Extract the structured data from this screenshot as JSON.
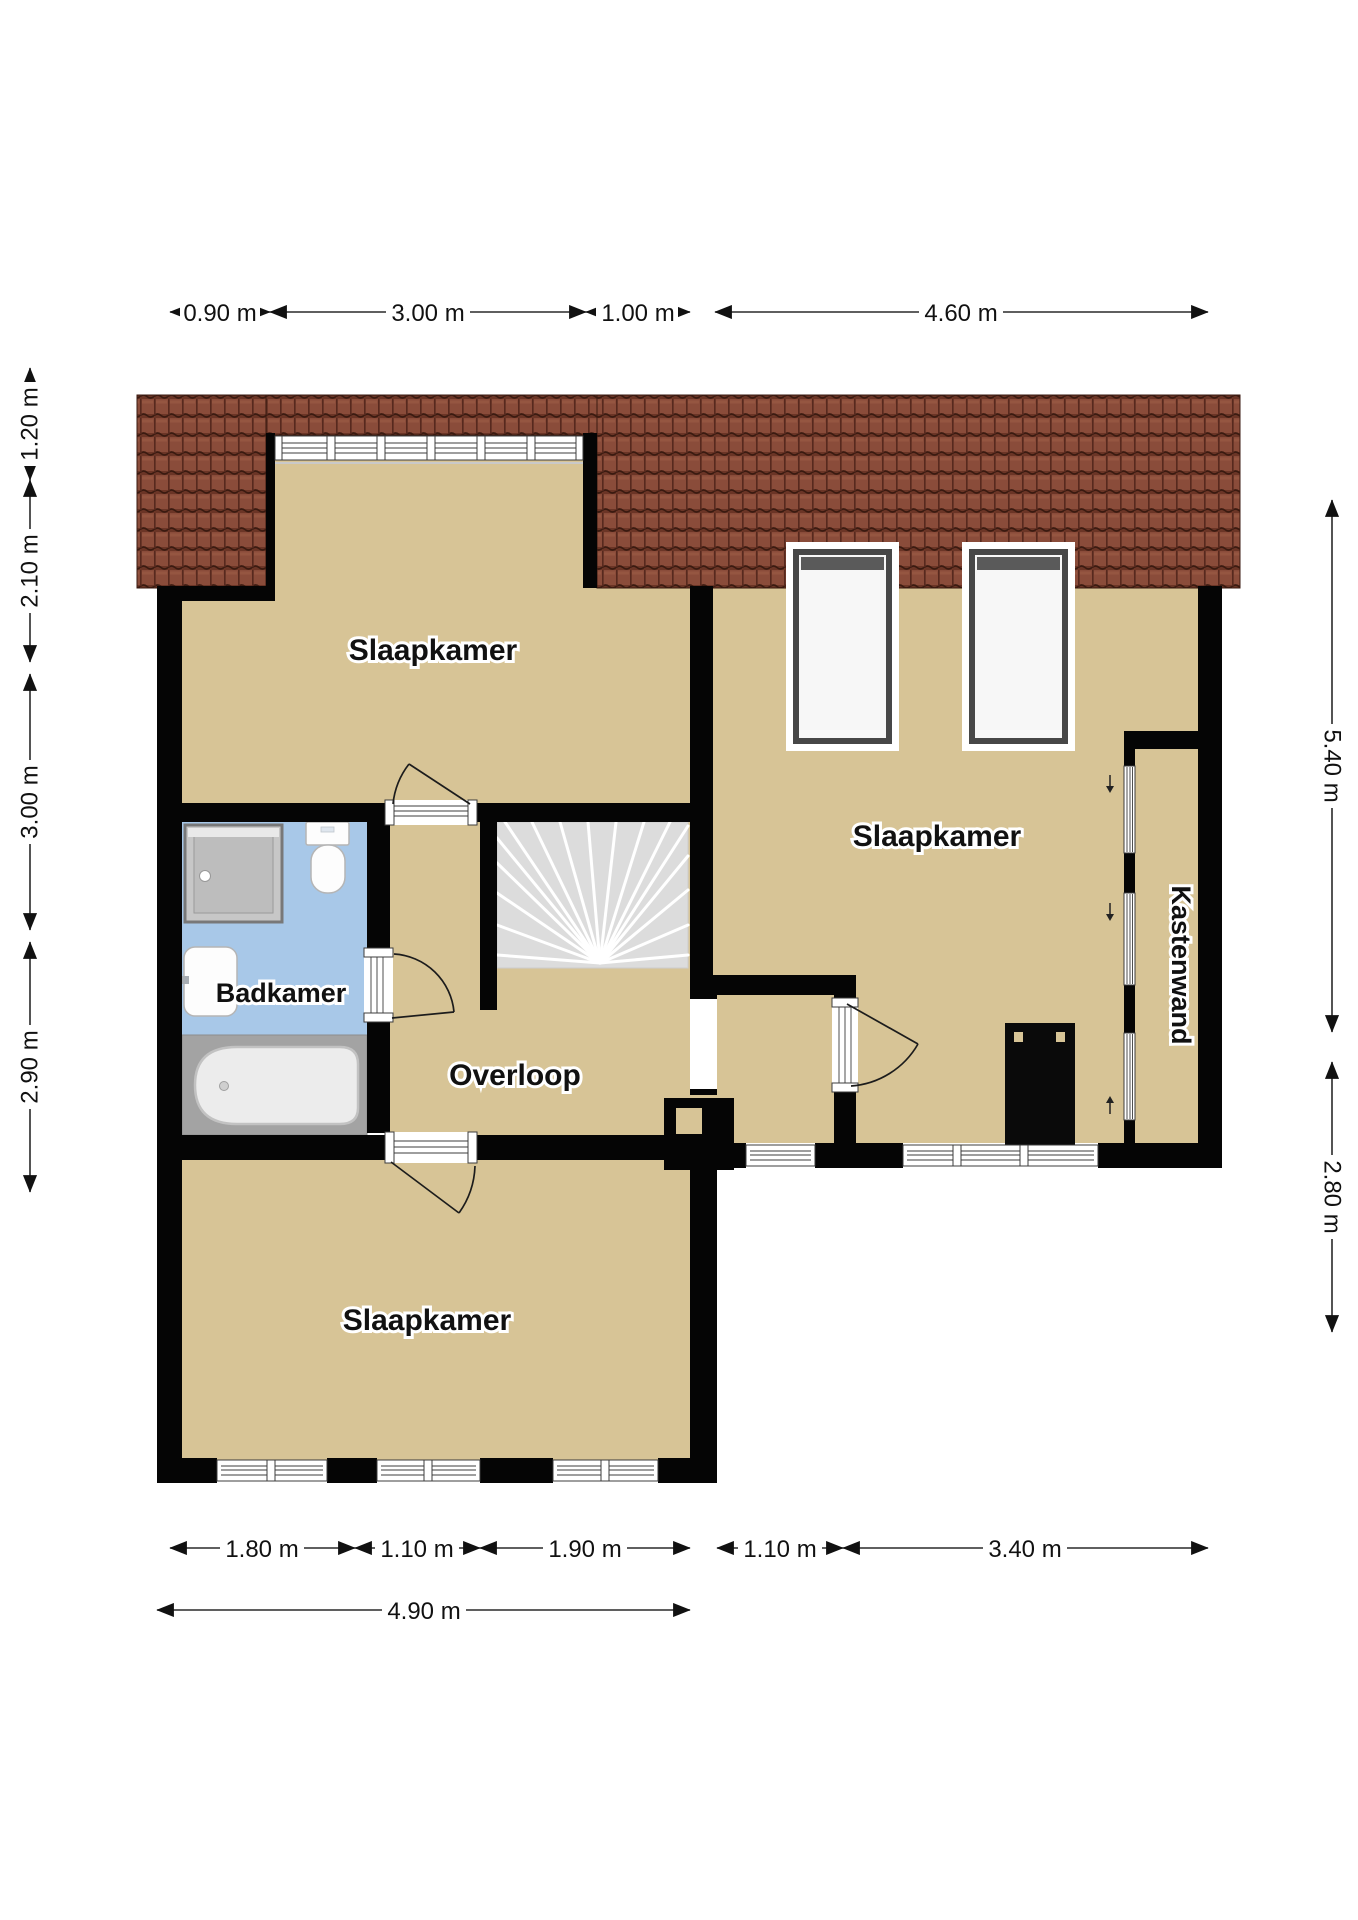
{
  "plan": {
    "type": "floorplan",
    "language": "nl",
    "rooms": {
      "bedroom_top_left": "Slaapkamer",
      "bedroom_right": "Slaapkamer",
      "bedroom_bottom_left": "Slaapkamer",
      "bathroom": "Badkamer",
      "landing": "Overloop",
      "closet_wall": "Kastenwand"
    },
    "dimensions": {
      "top": [
        "0.90 m",
        "3.00 m",
        "1.00 m",
        "4.60 m"
      ],
      "left": [
        "1.20 m",
        "2.10 m",
        "3.00 m",
        "2.90 m"
      ],
      "right": [
        "5.40 m",
        "2.80 m"
      ],
      "bottom": [
        "1.80 m",
        "1.10 m",
        "1.90 m",
        "1.10 m",
        "3.40 m"
      ],
      "bottom_total": "4.90 m"
    },
    "fixtures": [
      "shower",
      "toilet",
      "sink",
      "bathtub",
      "stairs",
      "stove",
      "skylight",
      "skylight",
      "dormer-window"
    ],
    "colors": {
      "floor": "#d7c496",
      "bathroom_floor": "#a8c8e8",
      "bath_platform": "#a3a3a3",
      "roof_tile": "#8a4c3a",
      "roof_tile_dark": "#5d2c1f",
      "wall": "#050505",
      "stairs": "#dcdcdc",
      "dimension_text": "#111111"
    }
  }
}
